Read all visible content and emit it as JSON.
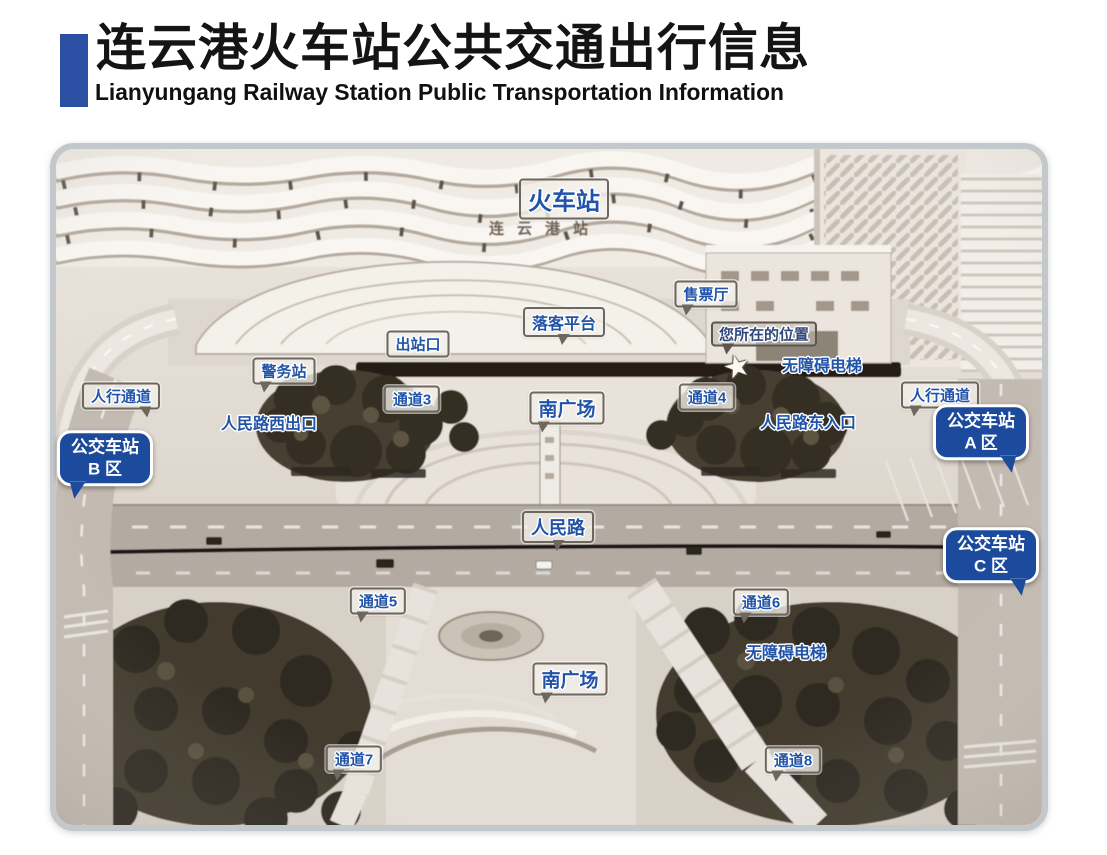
{
  "header": {
    "title_zh": "连云港火车站公共交通出行信息",
    "title_en": "Lianyungang Railway Station Public Transportation Information",
    "accent_color": "#2b4fa2"
  },
  "map": {
    "colors": {
      "label_text_blue": "#2154a8",
      "bus_bubble_blue": "#1c4a9c",
      "label_box_border": "#6e675e",
      "card_border_gray": "#c2c8cb"
    },
    "labels": [
      {
        "name": "railway-station-label",
        "text": "火车站",
        "type": "box",
        "x": 564,
        "y": 199,
        "fs": 24
      },
      {
        "name": "station-building-sign",
        "text": "连云港站",
        "type": "sign",
        "x": 545,
        "y": 228
      },
      {
        "name": "drop-off-platform-label",
        "text": "落客平台",
        "type": "box",
        "x": 564,
        "y": 322,
        "fs": 16,
        "tail": "d"
      },
      {
        "name": "ticket-hall-label",
        "text": "售票厅",
        "type": "box",
        "x": 706,
        "y": 294,
        "fs": 15,
        "tail": "dl"
      },
      {
        "name": "your-location-label",
        "text": "您所在的位置",
        "type": "ghost",
        "x": 764,
        "y": 334,
        "fs": 15,
        "tail": "dl"
      },
      {
        "name": "your-location-star",
        "text": "★",
        "type": "star",
        "x": 737,
        "y": 367
      },
      {
        "name": "accessible-elevator-north-label",
        "text": "无障碍电梯",
        "type": "plain",
        "x": 822,
        "y": 364,
        "fs": 16
      },
      {
        "name": "exit-gate-label",
        "text": "出站口",
        "type": "box",
        "x": 418,
        "y": 344,
        "fs": 15
      },
      {
        "name": "police-station-label",
        "text": "警务站",
        "type": "box",
        "x": 284,
        "y": 371,
        "fs": 15,
        "tail": "dl"
      },
      {
        "name": "passage-3-label",
        "text": "通道3",
        "type": "box",
        "x": 412,
        "y": 399,
        "fs": 15
      },
      {
        "name": "south-square-north-label",
        "text": "南广场",
        "type": "box",
        "x": 567,
        "y": 408,
        "fs": 19,
        "tail": "dl"
      },
      {
        "name": "renmin-road-west-exit-label",
        "text": "人民路西出口",
        "type": "plain",
        "x": 269,
        "y": 422,
        "fs": 16
      },
      {
        "name": "passage-4-label",
        "text": "通道4",
        "type": "box",
        "x": 707,
        "y": 397,
        "fs": 15
      },
      {
        "name": "renmin-road-east-entrance-label",
        "text": "人民路东入口",
        "type": "plain",
        "x": 808,
        "y": 421,
        "fs": 16
      },
      {
        "name": "pedestrian-passage-west-label",
        "text": "人行通道",
        "type": "box",
        "x": 121,
        "y": 396,
        "fs": 15,
        "tail": "dr"
      },
      {
        "name": "pedestrian-passage-east-label",
        "text": "人行通道",
        "type": "box",
        "x": 940,
        "y": 395,
        "fs": 15,
        "tail": "dl"
      },
      {
        "name": "bus-station-zone-b-label",
        "text": "公交车站\nB 区",
        "type": "bubble",
        "x": 105,
        "y": 458,
        "tail": "bl"
      },
      {
        "name": "bus-station-zone-a-label",
        "text": "公交车站\nA 区",
        "type": "bubble",
        "x": 981,
        "y": 432,
        "tail": "br"
      },
      {
        "name": "bus-station-zone-c-label",
        "text": "公交车站\nC 区",
        "type": "bubble",
        "x": 991,
        "y": 555,
        "tail": "br"
      },
      {
        "name": "renmin-road-label",
        "text": "人民路",
        "type": "box",
        "x": 558,
        "y": 527,
        "fs": 18,
        "tail": "d"
      },
      {
        "name": "passage-5-label",
        "text": "通道5",
        "type": "box",
        "x": 378,
        "y": 601,
        "fs": 15,
        "tail": "dl"
      },
      {
        "name": "passage-6-label",
        "text": "通道6",
        "type": "box",
        "x": 761,
        "y": 602,
        "fs": 15,
        "tail": "dl"
      },
      {
        "name": "accessible-elevator-south-label",
        "text": "无障碍电梯",
        "type": "plain",
        "x": 786,
        "y": 651,
        "fs": 16
      },
      {
        "name": "south-square-south-label",
        "text": "南广场",
        "type": "box",
        "x": 570,
        "y": 679,
        "fs": 19,
        "tail": "dl"
      },
      {
        "name": "passage-7-label",
        "text": "通道7",
        "type": "box",
        "x": 354,
        "y": 759,
        "fs": 15,
        "tail": "dl"
      },
      {
        "name": "passage-8-label",
        "text": "通道8",
        "type": "box",
        "x": 793,
        "y": 760,
        "fs": 15,
        "tail": "dl"
      }
    ]
  }
}
